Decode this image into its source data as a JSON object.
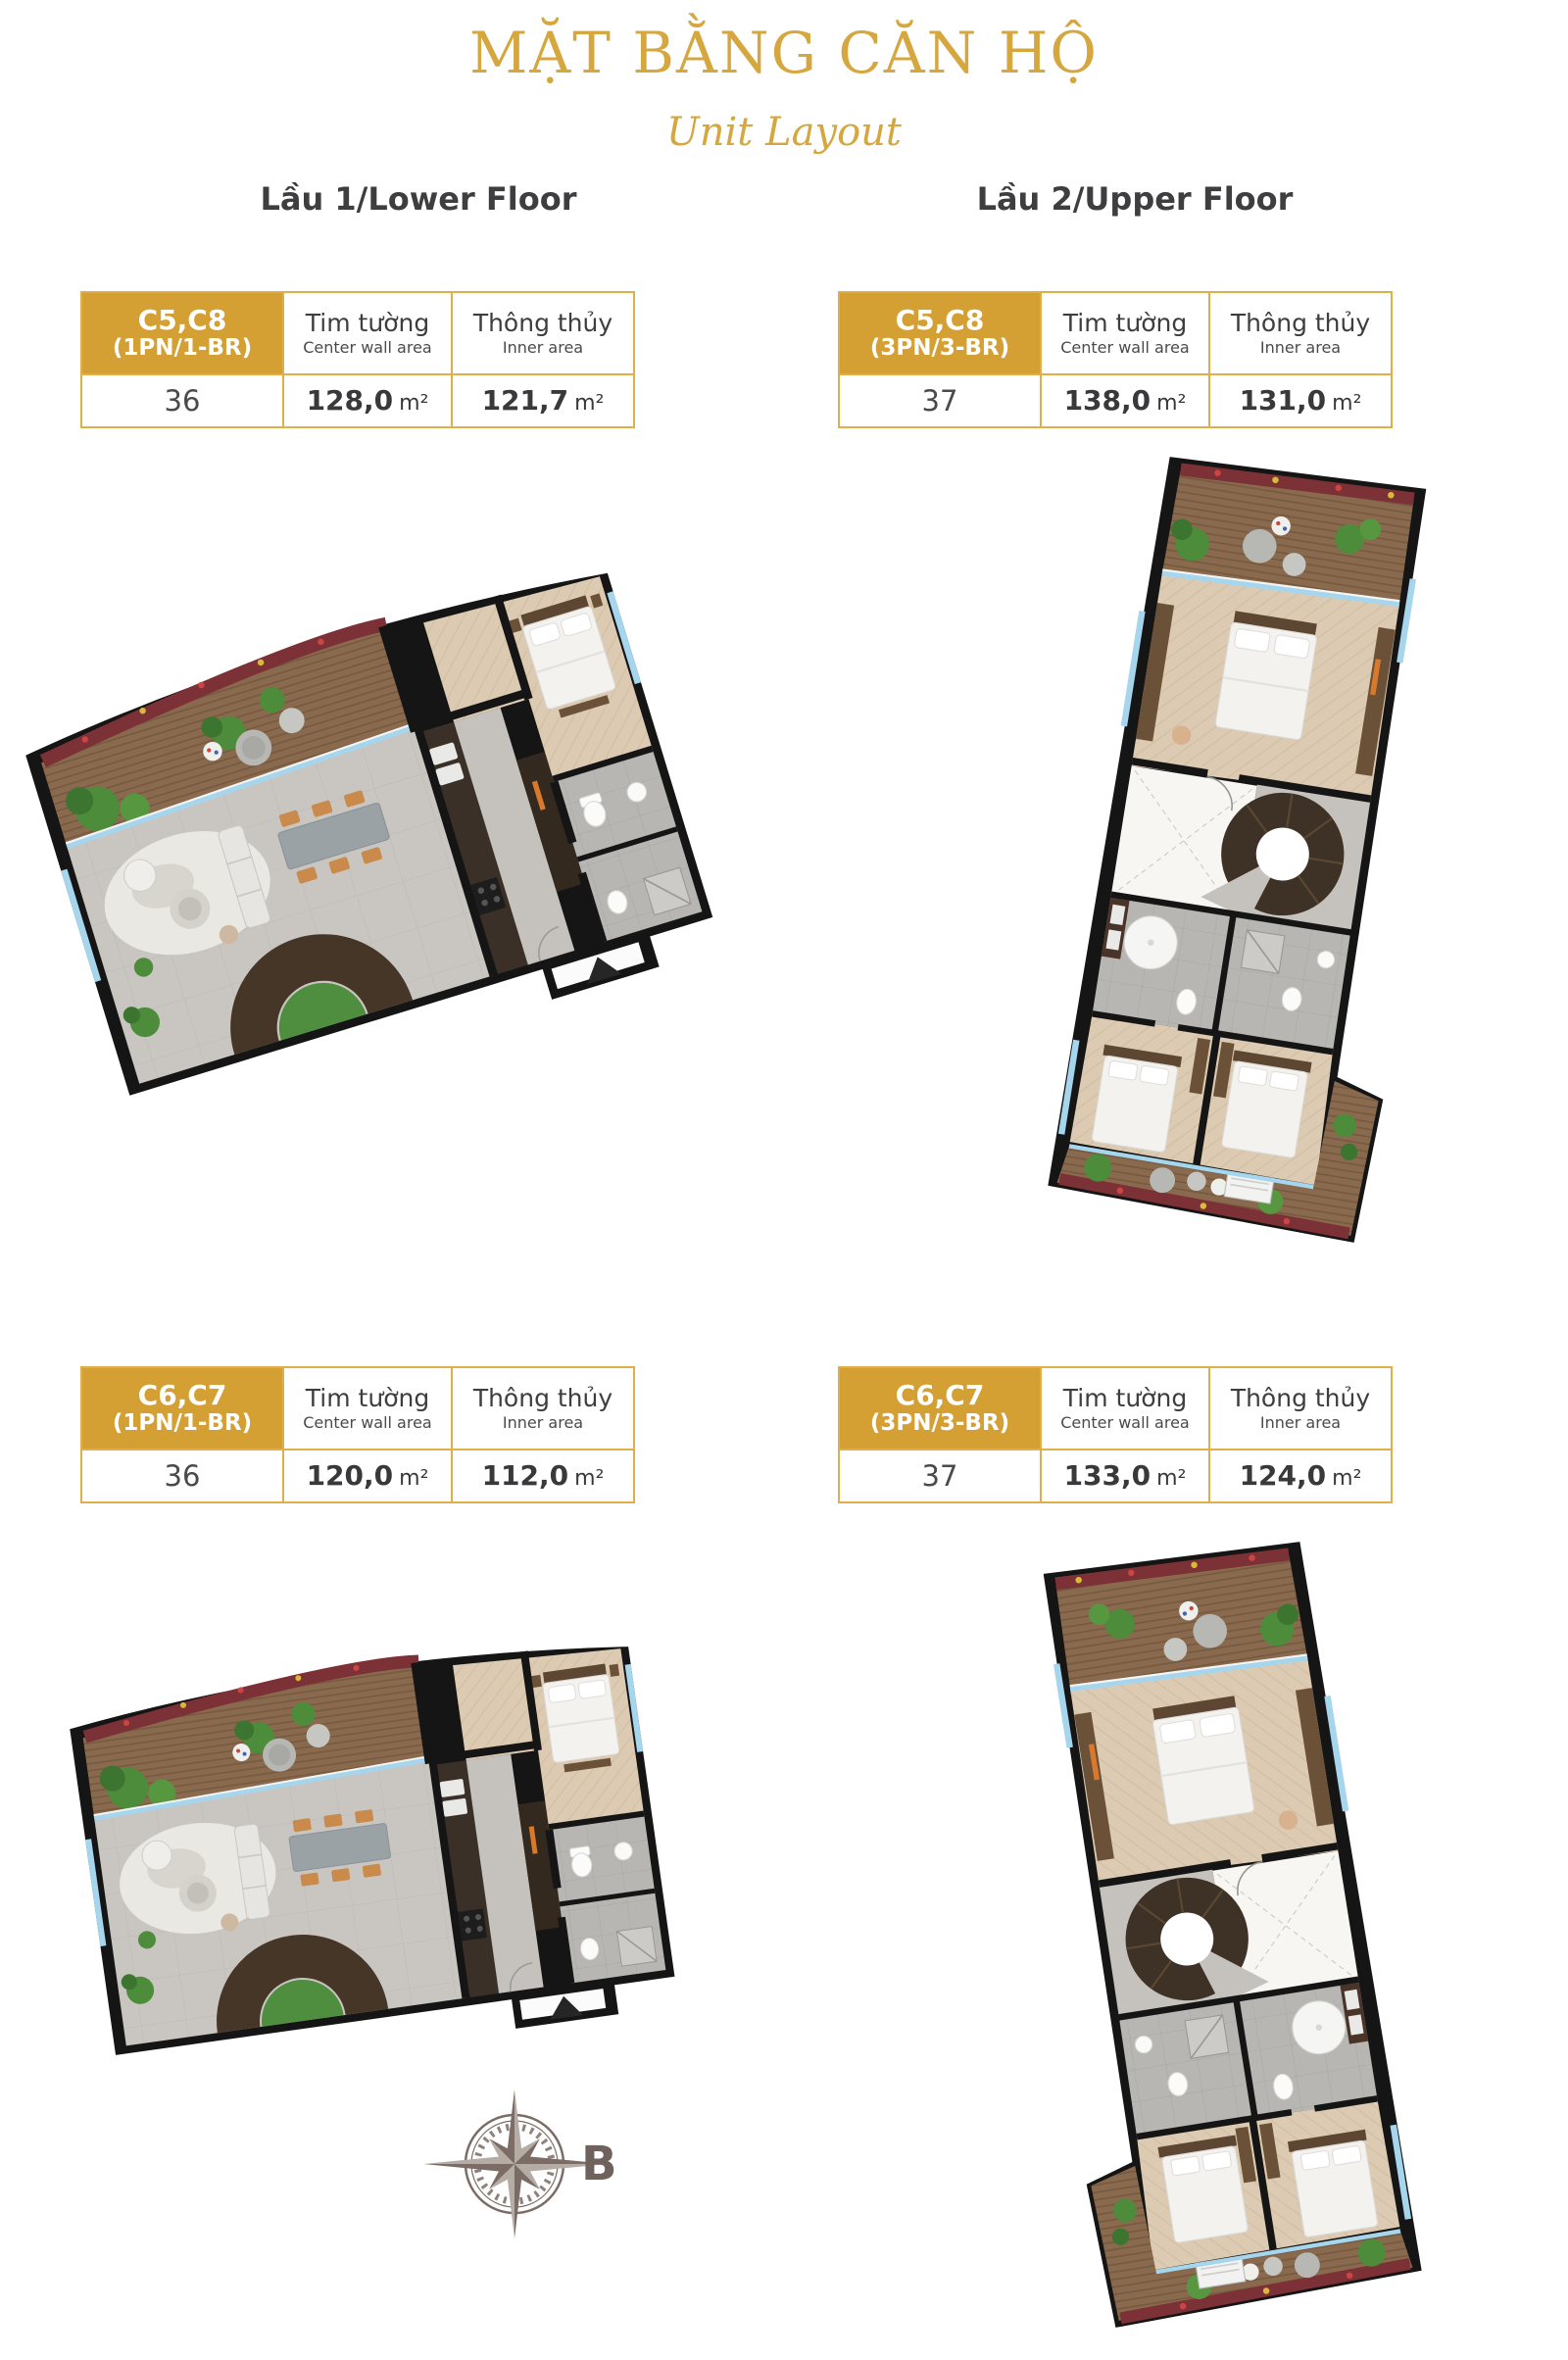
{
  "page": {
    "title": "MẶT BẰNG CĂN HỘ",
    "subtitle": "Unit Layout"
  },
  "columns": {
    "lower_heading": "Lầu 1/Lower Floor",
    "upper_heading": "Lầu 2/Upper Floor"
  },
  "table_headers": {
    "center_wall_vi": "Tim tường",
    "center_wall_en": "Center wall area",
    "inner_vi": "Thông thủy",
    "inner_en": "Inner area"
  },
  "tables": [
    {
      "unit": "C5,C8",
      "type": "(1PN/1-BR)",
      "level": "36",
      "center_wall": "128,0",
      "inner": "121,7",
      "area_unit": "m²"
    },
    {
      "unit": "C5,C8",
      "type": "(3PN/3-BR)",
      "level": "37",
      "center_wall": "138,0",
      "inner": "131,0",
      "area_unit": "m²"
    },
    {
      "unit": "C6,C7",
      "type": "(1PN/1-BR)",
      "level": "36",
      "center_wall": "120,0",
      "inner": "112,0",
      "area_unit": "m²"
    },
    {
      "unit": "C6,C7",
      "type": "(3PN/3-BR)",
      "level": "37",
      "center_wall": "133,0",
      "inner": "124,0",
      "area_unit": "m²"
    }
  ],
  "compass": {
    "label": "B"
  },
  "colors": {
    "gold": "#D5A033",
    "gold_border": "#E0AF49",
    "heading_text": "#3E3E40",
    "compass": "#7B6C66",
    "plan_wall": "#151515",
    "plan_deck": "#8A6A4E",
    "plan_tile": "#C9C6C1",
    "plan_plant": "#4C8C3A",
    "plan_window": "#A6D6EE"
  }
}
